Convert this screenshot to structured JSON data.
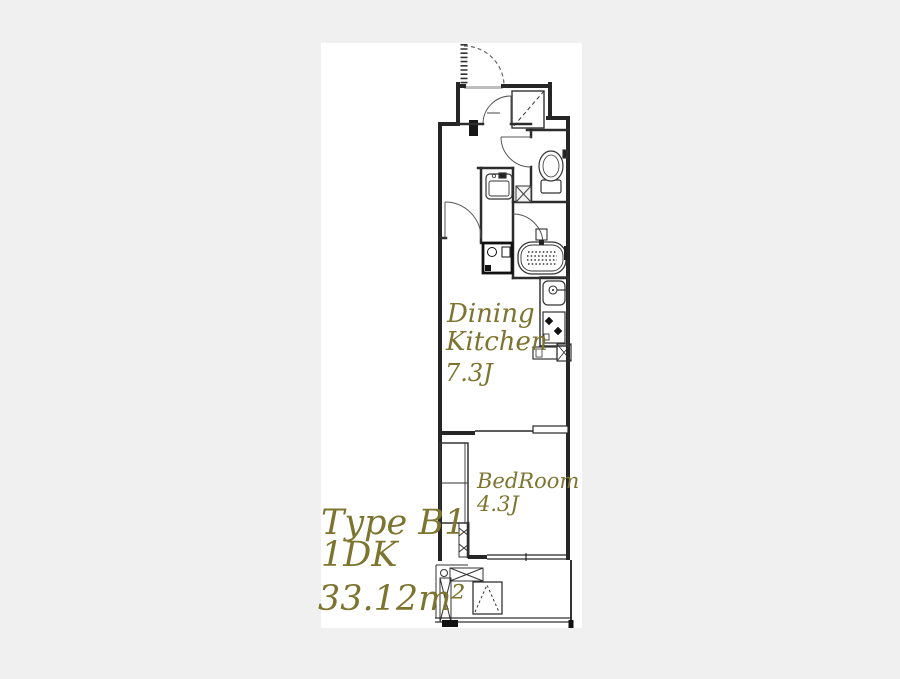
{
  "page": {
    "background_color": "#f0f0f0",
    "canvas_color": "#ffffff"
  },
  "plan": {
    "title": {
      "type_label": "Type B1",
      "layout_label": "1DK",
      "area_label": "33.12m²"
    },
    "rooms": {
      "dining_kitchen": {
        "name_line1": "Dining",
        "name_line2": "Kitchen",
        "size_label": "7.3J"
      },
      "bedroom": {
        "name": "BedRoom",
        "size_label": "4.3J"
      }
    },
    "colors": {
      "label_color": "#7d742f",
      "wall_color": "#262626",
      "fixture_color": "#3a3a3a",
      "sill_color": "#bdbdbd"
    }
  }
}
